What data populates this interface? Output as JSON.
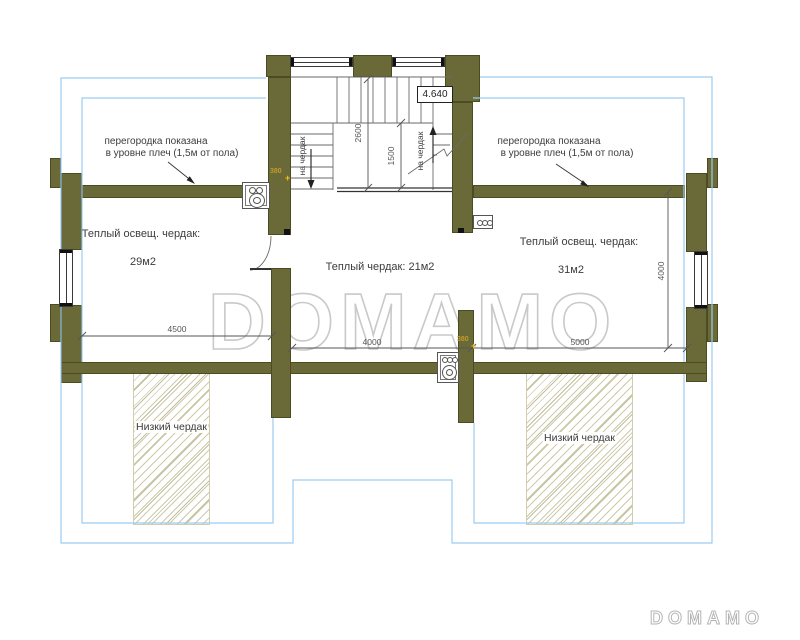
{
  "plan": {
    "level_mark": "4.640",
    "partition_note": {
      "line1": "перегородка показана",
      "line2": "в уровне плеч (1,5м от пола)"
    },
    "rooms": {
      "left": {
        "label": "Теплый освещ. чердак:",
        "area": "29м2"
      },
      "center": {
        "label": "Теплый чердак: 21м2"
      },
      "right": {
        "label": "Теплый освещ. чердак:",
        "area": "31м2"
      },
      "low_left": {
        "label": "Низкий чердак"
      },
      "low_right": {
        "label": "Низкий чердак"
      }
    },
    "stairs": {
      "down_label": "на чердак",
      "up_label": "на чердак"
    },
    "dimensions": {
      "left_width": "4500",
      "center_width": "4000",
      "right_width": "5000",
      "right_height": "4000",
      "stair_total": "2600",
      "stair_run": "1500",
      "wall_380_a": "380",
      "wall_380_b": "380"
    },
    "markers": {
      "plus_a": "+",
      "plus_b": "+"
    }
  },
  "watermark": {
    "center": "DOMAMO",
    "corner": "DOMAMO"
  },
  "colors": {
    "wall": "#6a6a38",
    "roof_outline": "#9cccf0",
    "hatch": "#cfcaa8",
    "dim": "#555555",
    "text": "#3c3c3c",
    "thickness_label": "#c39a2a",
    "marker": "#f0c018"
  }
}
